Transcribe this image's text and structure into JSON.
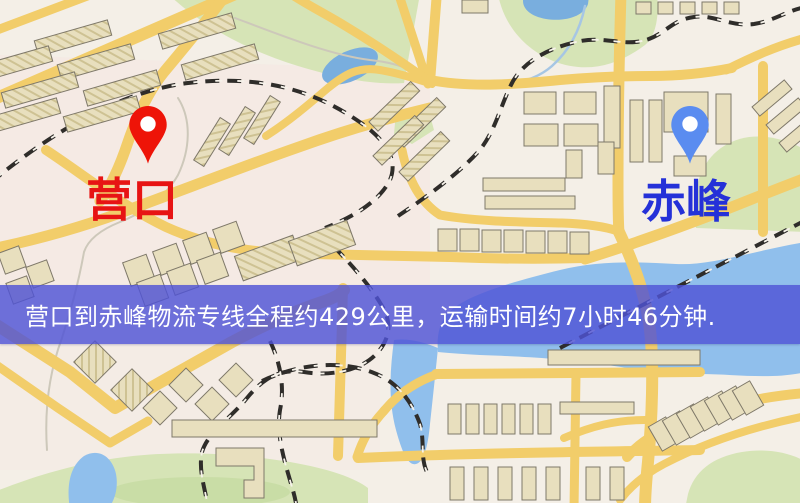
{
  "markers": {
    "origin": {
      "label": "营口"
    },
    "destination": {
      "label": "赤峰"
    }
  },
  "banner": {
    "text": "营口到赤峰物流专线全程约429公里，运输时间约7小时46分钟."
  },
  "route": {
    "origin": "营口",
    "destination": "赤峰",
    "distance_km": 429,
    "duration_hours": 7,
    "duration_minutes": 46
  },
  "colors": {
    "map-bg": "#f4efe7",
    "park": "#d6e4b6",
    "park-dark": "#c9dda6",
    "water": "#90bfec",
    "pond": "#79aede",
    "road": "#f2cd6a",
    "building": "#e8dfbe",
    "building-stroke": "#7e7869",
    "railway": "#2f2d2a",
    "railway-tie": "#f6f2ea",
    "pin-origin": "#ee1408",
    "pin-destination": "#5a8cf0",
    "label-origin": "#e71414",
    "label-destination": "#2531d8",
    "banner-bg": "rgba(79,83,214,0.82)",
    "banner-text": "#ffffff"
  }
}
